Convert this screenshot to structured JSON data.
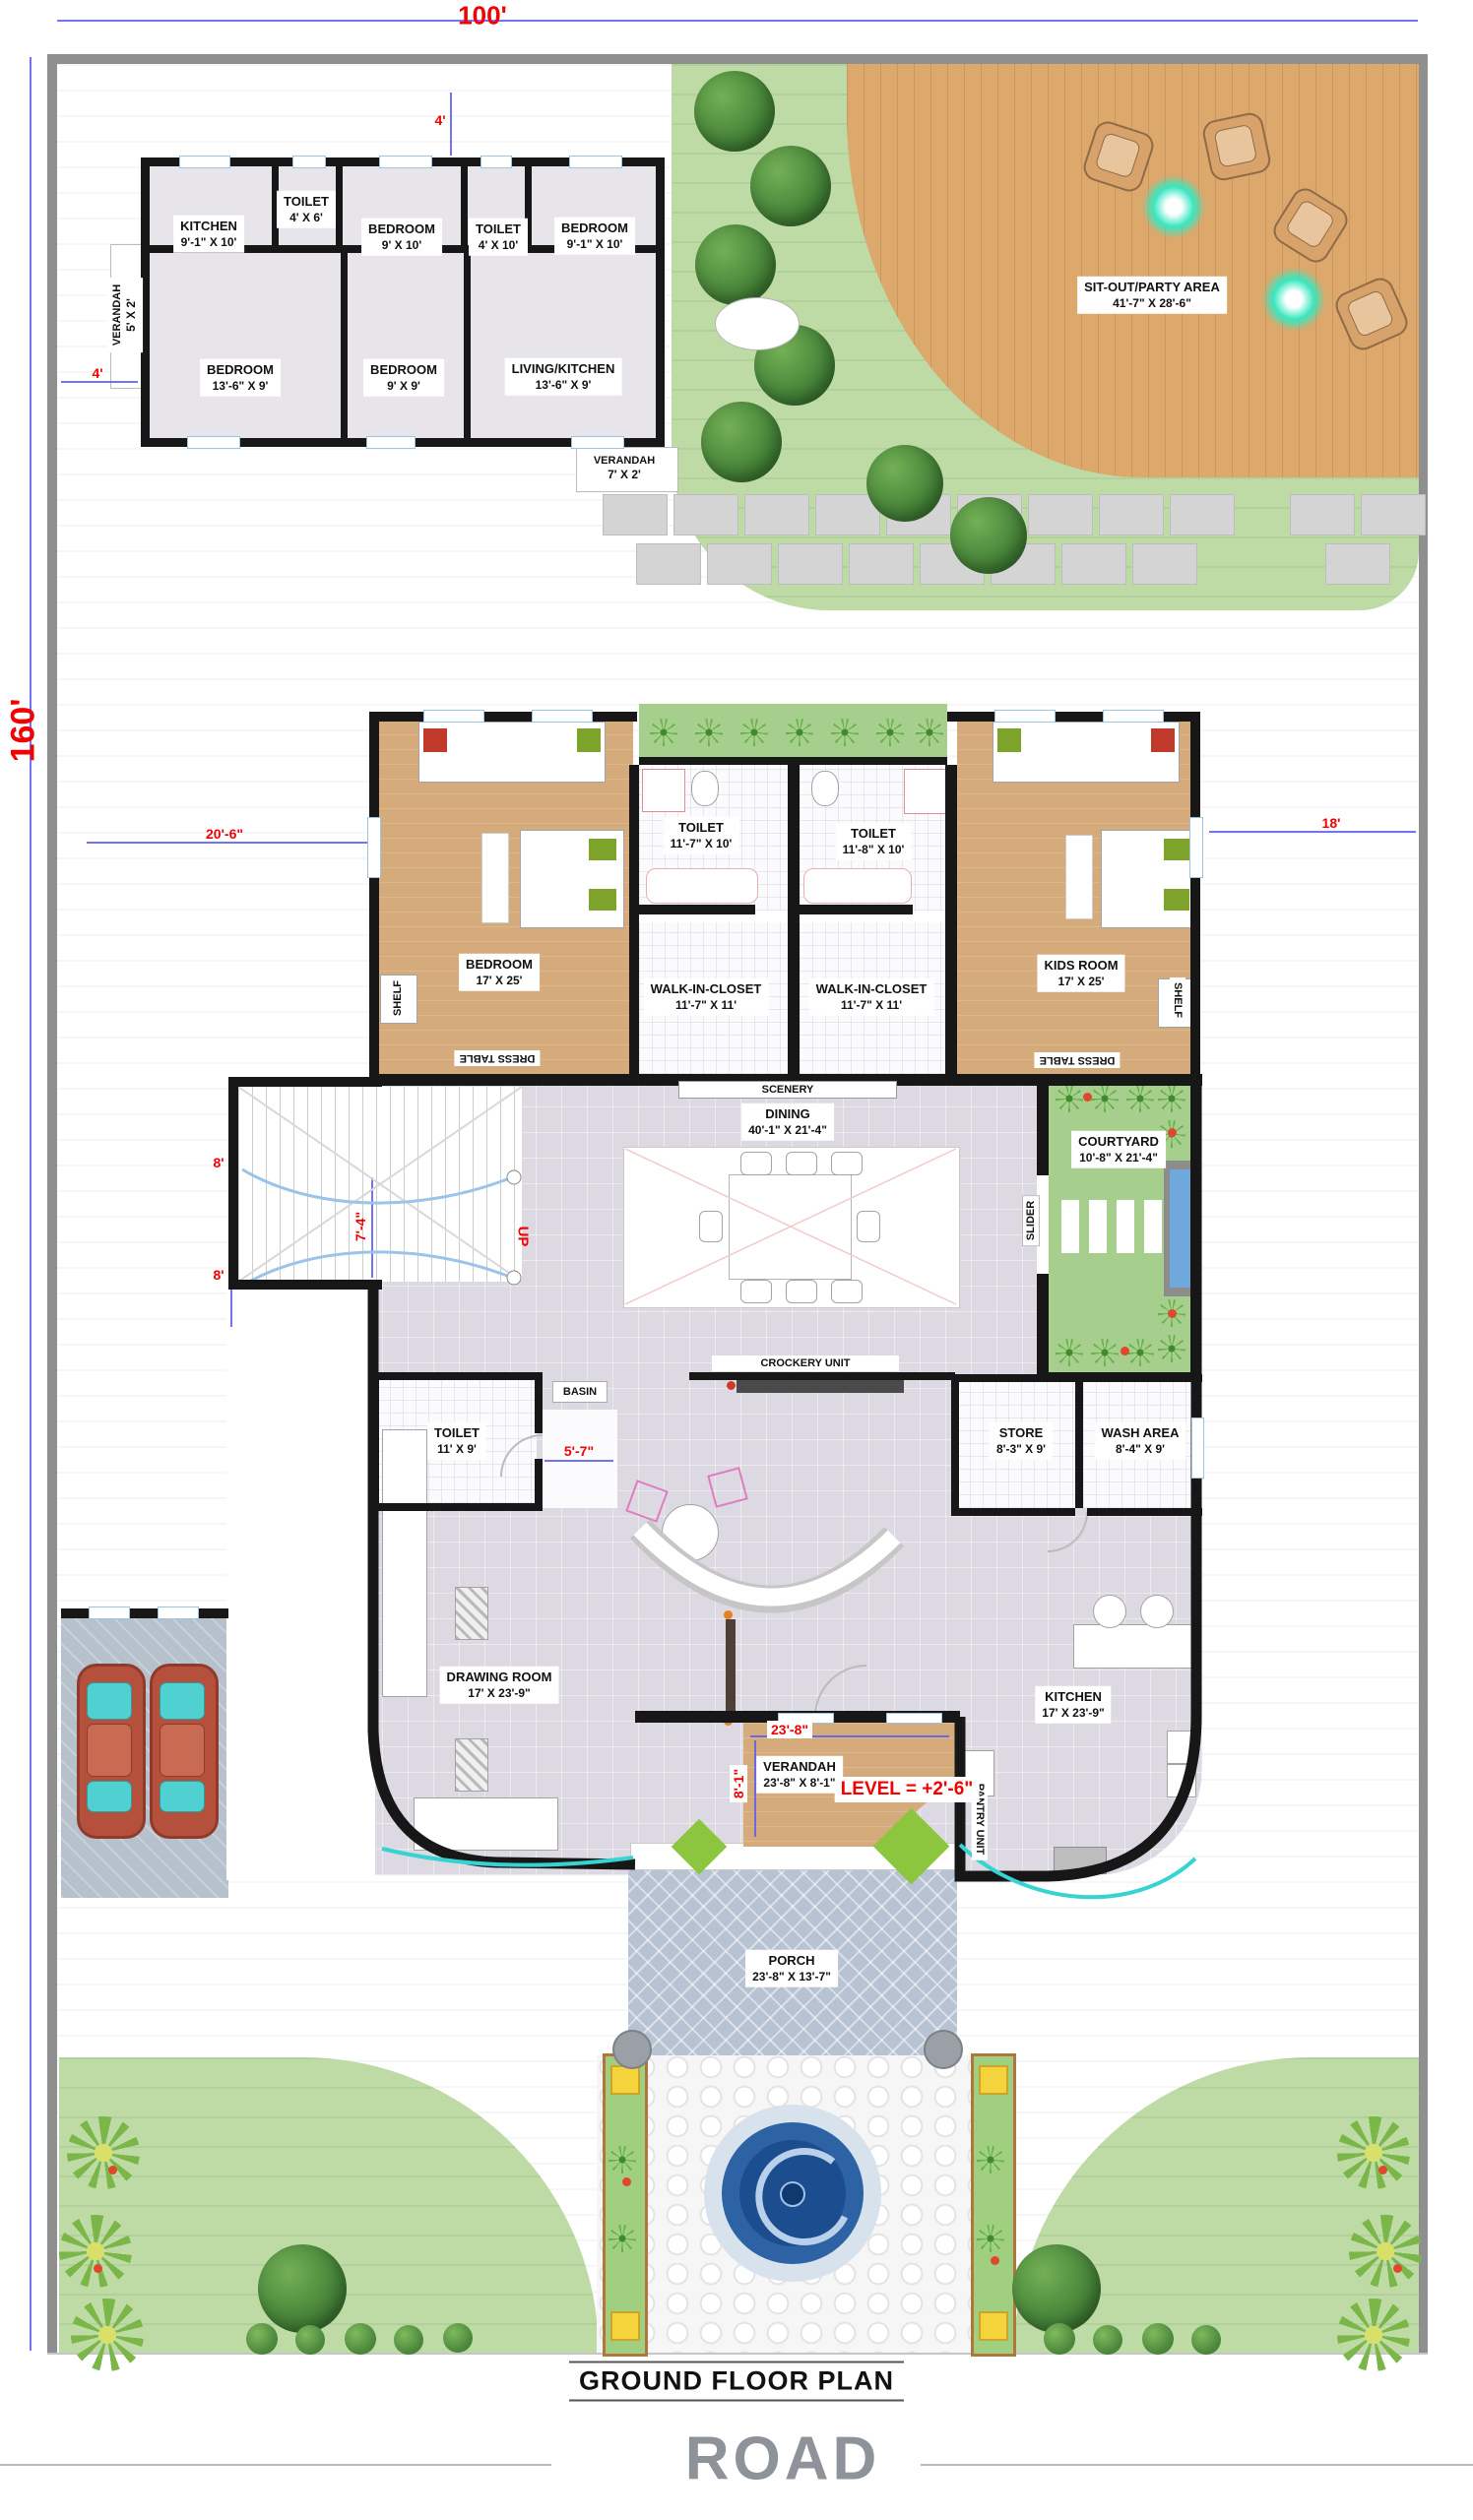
{
  "plan": {
    "title": "GROUND FLOOR PLAN",
    "road_label": "ROAD"
  },
  "rooms": [
    {
      "name": "KITCHEN",
      "dim": "9'-1\" X 10'"
    },
    {
      "name": "TOILET",
      "dim": "4' X 6'"
    },
    {
      "name": "BEDROOM",
      "dim": "9' X 10'"
    },
    {
      "name": "TOILET",
      "dim": "4' X 10'"
    },
    {
      "name": "BEDROOM",
      "dim": "9'-1\" X 10'"
    },
    {
      "name": "VERANDAH",
      "dim": "5' X 2'"
    },
    {
      "name": "BEDROOM",
      "dim": "13'-6\" X 9'"
    },
    {
      "name": "BEDROOM",
      "dim": "9' X 9'"
    },
    {
      "name": "LIVING/KITCHEN",
      "dim": "13'-6\" X 9'"
    },
    {
      "name": "VERANDAH",
      "dim": "7' X 2'"
    },
    {
      "name": "SIT-OUT/PARTY AREA",
      "dim": "41'-7\" X 28'-6\""
    },
    {
      "name": "BEDROOM",
      "dim": "17' X 25'"
    },
    {
      "name": "TOILET",
      "dim": "11'-7\" X 10'"
    },
    {
      "name": "TOILET",
      "dim": "11'-8\" X 10'"
    },
    {
      "name": "WALK-IN-CLOSET",
      "dim": "11'-7\" X 11'"
    },
    {
      "name": "WALK-IN-CLOSET",
      "dim": "11'-7\" X 11'"
    },
    {
      "name": "KIDS ROOM",
      "dim": "17' X 25'"
    },
    {
      "name": "DINING",
      "dim": "40'-1\" X 21'-4\""
    },
    {
      "name": "COURTYARD",
      "dim": "10'-8\" X 21'-4\""
    },
    {
      "name": "TOILET",
      "dim": "11' X 9'"
    },
    {
      "name": "STORE",
      "dim": "8'-3\" X 9'"
    },
    {
      "name": "WASH AREA",
      "dim": "8'-4\" X 9'"
    },
    {
      "name": "DRAWING ROOM",
      "dim": "17' X 23'-9\""
    },
    {
      "name": "KITCHEN",
      "dim": "17' X 23'-9\""
    },
    {
      "name": "VERANDAH",
      "dim": "23'-8\" X 8'-1\""
    },
    {
      "name": "PORCH",
      "dim": "23'-8\" X 13'-7\""
    }
  ],
  "labels": [
    "SCENERY",
    "CROCKERY UNIT",
    "BASIN",
    "SHELF",
    "SHELF",
    "DRESS TABLE",
    "DRESS TABLE",
    "SLIDER",
    "PANTRY UNIT"
  ],
  "dims": [
    "100'",
    "160'",
    "4'",
    "4'",
    "20'-6\"",
    "18'",
    "8'",
    "7'-4\"",
    "8'",
    "5'-7\"",
    "23'-8\"",
    "8'-1\"",
    "LEVEL = +2'-6\"",
    "UP"
  ],
  "colors": {
    "wall": "#171717",
    "wood": "#d5ab7c",
    "deck": "#dca86c",
    "lawn": "#bedaa5",
    "court": "#a6cf8d",
    "floor": "#dcd9e2",
    "porch": "#b7c2d2",
    "garage": "#b6c1cc",
    "water": "#6fa8dc",
    "pool": "#1c4d8e",
    "dimred": "#f30000",
    "dimblue": "#5a5af2",
    "glow": "#38e7c0",
    "lime": "#8cc63f",
    "roadgray": "#8e9399"
  }
}
